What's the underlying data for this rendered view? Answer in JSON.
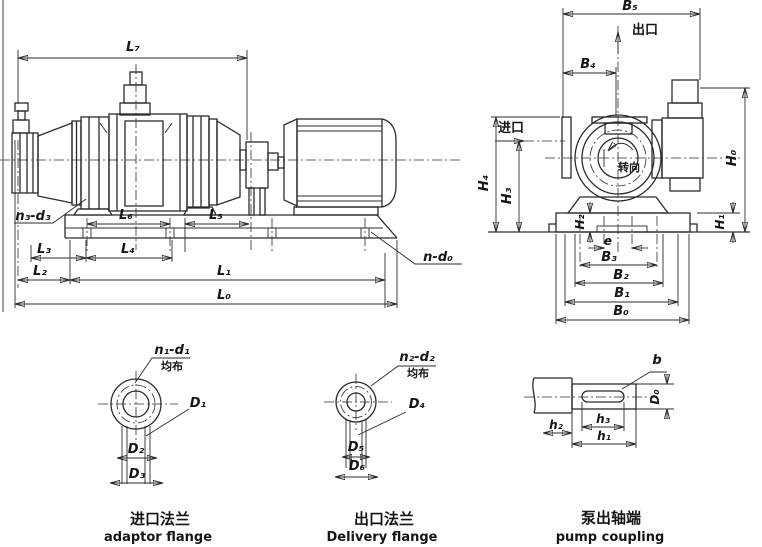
{
  "colors": {
    "ink": "#2b2b2b",
    "paper": "#ffffff"
  },
  "side_view": {
    "dims": {
      "L0": "L₀",
      "L1": "L₁",
      "L2": "L₂",
      "L3": "L₃",
      "L4": "L₄",
      "L5": "L₅",
      "L6": "L₆",
      "L7": "L₇"
    },
    "holes": {
      "base_bolts": "n₃-d₃",
      "foundation_bolts": "n-d₀"
    }
  },
  "end_view": {
    "dims": {
      "B0": "B₀",
      "B1": "B₁",
      "B2": "B₂",
      "B3": "B₃",
      "B4": "B₄",
      "B5": "B₅",
      "H0": "H₀",
      "H1": "H₁",
      "H2": "H₂",
      "H3": "H₃",
      "H4": "H₄",
      "e": "e"
    },
    "labels": {
      "outlet": "出口",
      "inlet": "进口",
      "rotation": "转向"
    }
  },
  "inlet_flange": {
    "holes": "n₁-d₁",
    "evenly": "均布",
    "dims": {
      "D1": "D₁",
      "D2": "D₂",
      "D3": "D₃"
    },
    "caption_zh": "进口法兰",
    "caption_en": "adaptor flange"
  },
  "outlet_flange": {
    "holes": "n₂-d₂",
    "evenly": "均布",
    "dims": {
      "D4": "D₄",
      "D5": "D₅",
      "D6": "D₆"
    },
    "caption_zh": "出口法兰",
    "caption_en": "Delivery flange"
  },
  "shaft_end": {
    "dims": {
      "b": "b",
      "D0": "D₀",
      "h1": "h₁",
      "h2": "h₂",
      "h3": "h₃"
    },
    "caption_zh": "泵出轴端",
    "caption_en": "pump coupling"
  }
}
